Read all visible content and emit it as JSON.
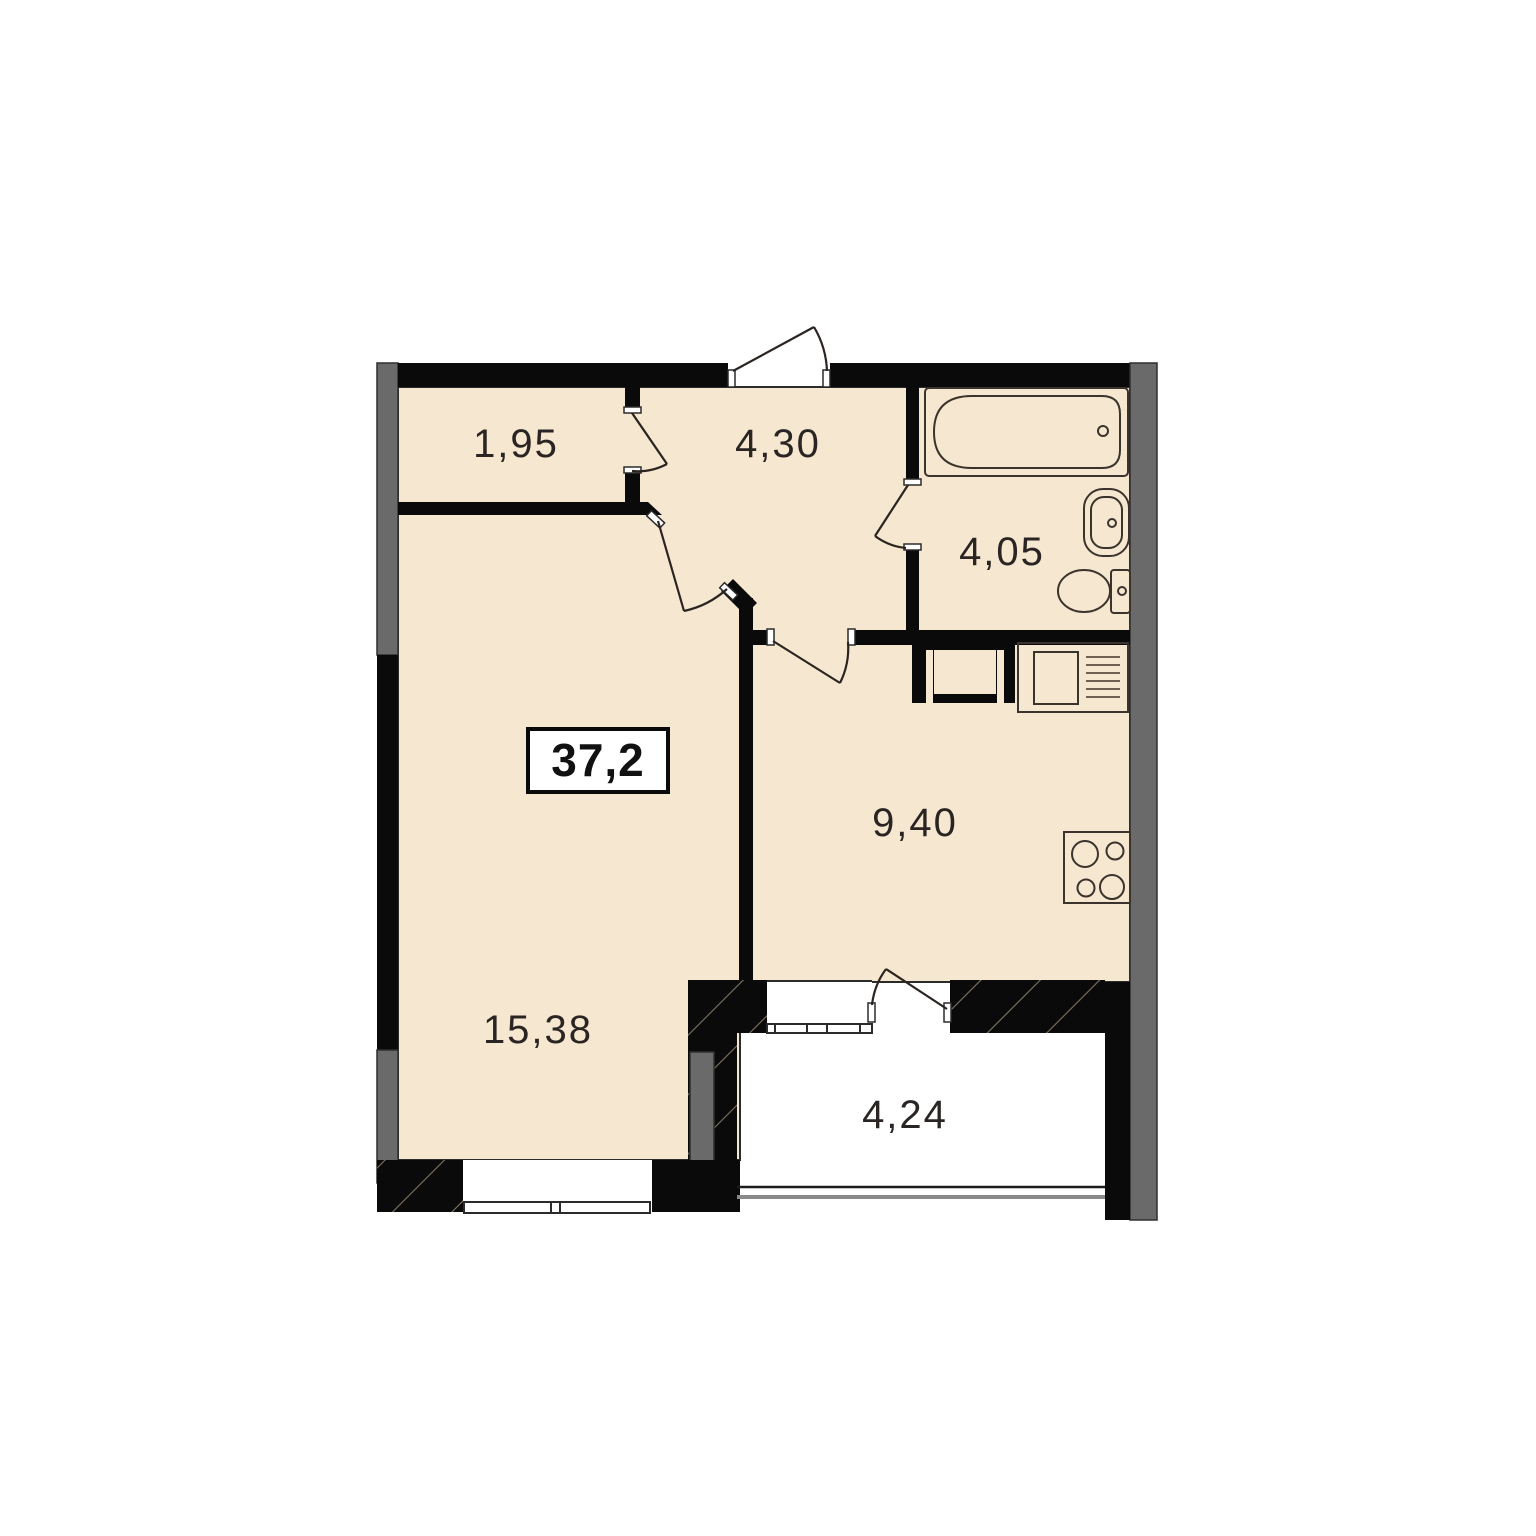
{
  "plan": {
    "title": "one-room apartment floor plan",
    "total_area_label": "37,2",
    "rooms": [
      {
        "id": "storage",
        "area_label": "1,95"
      },
      {
        "id": "hallway",
        "area_label": "4,30"
      },
      {
        "id": "bathroom",
        "area_label": "4,05"
      },
      {
        "id": "kitchen",
        "area_label": "9,40"
      },
      {
        "id": "living-room",
        "area_label": "15,38"
      },
      {
        "id": "balcony",
        "area_label": "4,24"
      }
    ],
    "fixtures": [
      "bathtub",
      "wash-basin",
      "toilet",
      "ventilation-shaft",
      "kitchen-sink",
      "stove"
    ],
    "colors": {
      "floor": "#f6e7d0",
      "wall": "#0a0a0a",
      "exterior_gray": "#6a6a6a",
      "balcony_floor": "#ffffff",
      "fixture_outline": "#3b342c"
    }
  }
}
